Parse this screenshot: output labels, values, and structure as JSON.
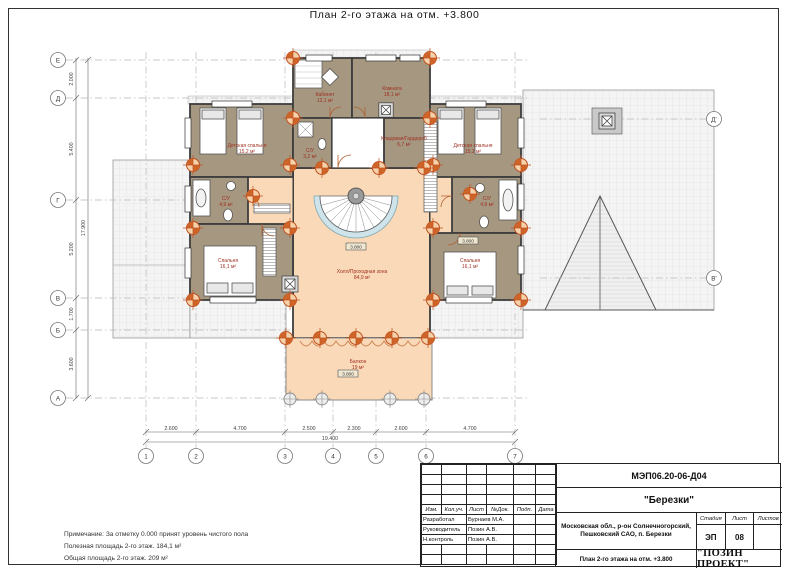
{
  "sheet": {
    "title": "План 2-го этажа на отм. +3.800"
  },
  "notes": {
    "line1": "Примечание: За отметку 0.000 принят уровень чистого пола",
    "line2": "Полезная площадь 2-го этаж. 184,1 м²",
    "line3": "Общая площадь 2-го этаж. 209 м²"
  },
  "title_block": {
    "doc_number": "МЭП06.20-06-Д04",
    "project_name": "\"Березки\"",
    "address_line1": "Московская обл., р-он Солнечногорский,",
    "address_line2": "Пешковский САО, п. Березки",
    "drawing_title": "План 2-го этажа на отм. +3.800",
    "company": "\"ПОЗИН ПРОЕКТ\"",
    "columns": [
      "Изм.",
      "Кол.уч.",
      "Лист",
      "№Док.",
      "Подп.",
      "Дата"
    ],
    "roles": [
      {
        "role": "Разработал",
        "name": "Бурнаев М.А."
      },
      {
        "role": "Руководитель",
        "name": "Позин А.В."
      },
      {
        "role": "Н.контроль",
        "name": "Позин А.В."
      }
    ],
    "stage_label": "Стадия",
    "sheet_label": "Лист",
    "sheets_label": "Листов",
    "stage": "ЭП",
    "sheet_no": "08",
    "sheets_total": ""
  },
  "axes": {
    "left": [
      "Е",
      "Д",
      "Г",
      "В",
      "Б",
      "А"
    ],
    "bottom": [
      "1",
      "2",
      "3",
      "4",
      "5",
      "6",
      "7"
    ],
    "right": [
      "Д'",
      "В'"
    ]
  },
  "dimensions": {
    "left": [
      "2.000",
      "5.400",
      "5.200",
      "1.700",
      "3.600"
    ],
    "left_total": "17.900",
    "bottom": [
      "2.600",
      "4.700",
      "2.500",
      "2.300",
      "2.600",
      "4.700"
    ],
    "bottom_total": "19.400"
  },
  "rooms": [
    {
      "name": "Холл/Проходная зона",
      "area": "84,9 м²"
    },
    {
      "name": "Балкон",
      "area": "19 м²"
    },
    {
      "name": "Детская спальня",
      "area": "15,2 м²"
    },
    {
      "name": "С/У",
      "area": "4,9 м²"
    },
    {
      "name": "Спальня",
      "area": "16,1 м²"
    },
    {
      "name": "Кабинет",
      "area": "12,1 м²"
    },
    {
      "name": "Комната",
      "area": "18,1 м²"
    },
    {
      "name": "С/У",
      "area": "3,2 м²"
    },
    {
      "name": "Кладовая/Гардероб",
      "area": "6,7 м²"
    },
    {
      "name": "Детская спальня",
      "area": "15,2 м²"
    },
    {
      "name": "С/У",
      "area": "4,9 м²"
    },
    {
      "name": "Спальня",
      "area": "16,1 м²"
    }
  ],
  "levels": {
    "hall": "3.800",
    "balcony": "3.800",
    "right_wing": "3.800"
  },
  "colors": {
    "floor_hall": "#f9d9b7",
    "floor_rooms": "#a59780",
    "roof": "#f3f3f3",
    "column_marker": "#c0501e",
    "room_label": "#a03122"
  }
}
